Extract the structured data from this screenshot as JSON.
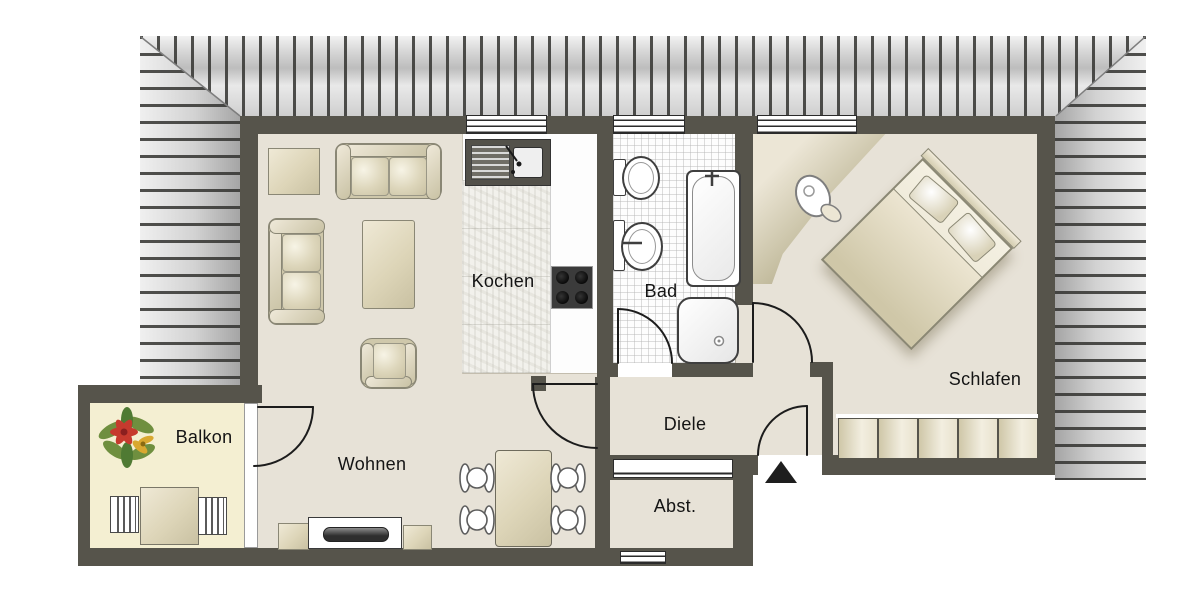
{
  "plan": {
    "title": "apartment-floor-plan",
    "rooms": [
      {
        "name": "wohnen",
        "label": "Wohnen"
      },
      {
        "name": "kochen",
        "label": "Kochen"
      },
      {
        "name": "bad",
        "label": "Bad"
      },
      {
        "name": "schlafen",
        "label": "Schlafen"
      },
      {
        "name": "diele",
        "label": "Diele"
      },
      {
        "name": "abstellraum",
        "label": "Abst."
      },
      {
        "name": "balkon",
        "label": "Balkon"
      }
    ],
    "colors": {
      "wall": "#56544b",
      "floor": "#e7e2d7",
      "balcony_floor": "#f4efd2",
      "kitchen_floor": "#fdfdfd",
      "roof_stripe": "#32322f",
      "furniture_beige": "#ddd5b8",
      "plant_red": "#c63a2e",
      "plant_green": "#6f8f3f",
      "plant_yellow": "#d9a830",
      "label_text": "#141414"
    },
    "markers": {
      "entrance": "triangle-up"
    }
  }
}
